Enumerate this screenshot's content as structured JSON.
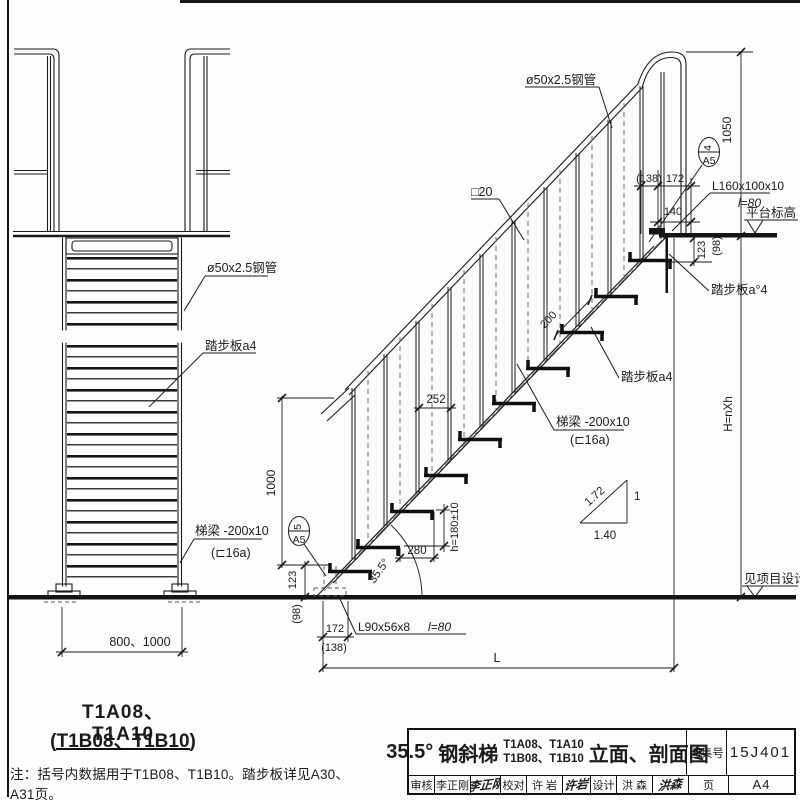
{
  "front_view": {
    "pipe_label": "ø50x2.5钢管",
    "tread_label": "踏步板a4",
    "stringer_label_1": "梯梁 -200x10",
    "stringer_label_2": "(⊏16a)",
    "width_dim": "800、1000",
    "model_line1": "T1A08、T1A10",
    "model_line2": "(T1B08、T1B10)"
  },
  "note": "注：括号内数据用于T1B08、T1B10。踏步板详见A30、A31页。",
  "section_view": {
    "pipe_label": "ø50x2.5钢管",
    "baluster_label": "□20",
    "top_bracket_label": "L160x100x10",
    "top_bracket_len": "l=80",
    "platform_label": "平台标高",
    "tread_label_top": "踏步板a°4",
    "tread_label_mid": "踏步板a4",
    "stringer_label_1": "梯梁 -200x10",
    "stringer_label_2": "(⊏16a)",
    "bottom_bracket_label": "L90x56x8",
    "bottom_bracket_len": "l=80",
    "see_project": "见项目设计",
    "dims": {
      "d1050": "1050",
      "d138_top": "(138)",
      "d172_top": "172",
      "d140": "140",
      "d123_top": "123",
      "d98_top": "(98)",
      "d200": "200",
      "d252": "252",
      "d280": "280",
      "dh": "h=180±10",
      "d1000": "1000",
      "d123_bot": "123",
      "d98_bot": "(98)",
      "d172_bot": "172",
      "d138_bot": "(138)",
      "angle": "35.5°",
      "dL": "L",
      "dH": "H=nXh",
      "slope_hyp": "1.72",
      "slope_v": "1",
      "slope_h": "1.40"
    },
    "callout_top": {
      "num": "4",
      "page": "A5"
    },
    "callout_bottom": {
      "num": "5",
      "page": "A5"
    }
  },
  "title_block": {
    "angle": "35.5°",
    "name": "钢斜梯",
    "models_line1": "T1A08、T1A10",
    "models_line2": "T1B08、T1B10",
    "suffix": "立面、剖面图",
    "atlas_label": "图集号",
    "atlas_no": "15J401",
    "page_label": "页",
    "page_no": "A4",
    "review_label": "审核",
    "review_name": "李正刚",
    "review_sig": "李正刚",
    "check_label": "校对",
    "check_name": "许 岩",
    "check_sig": "许岩",
    "design_label": "设计",
    "design_name": "洪 森",
    "design_sig": "洪森"
  }
}
